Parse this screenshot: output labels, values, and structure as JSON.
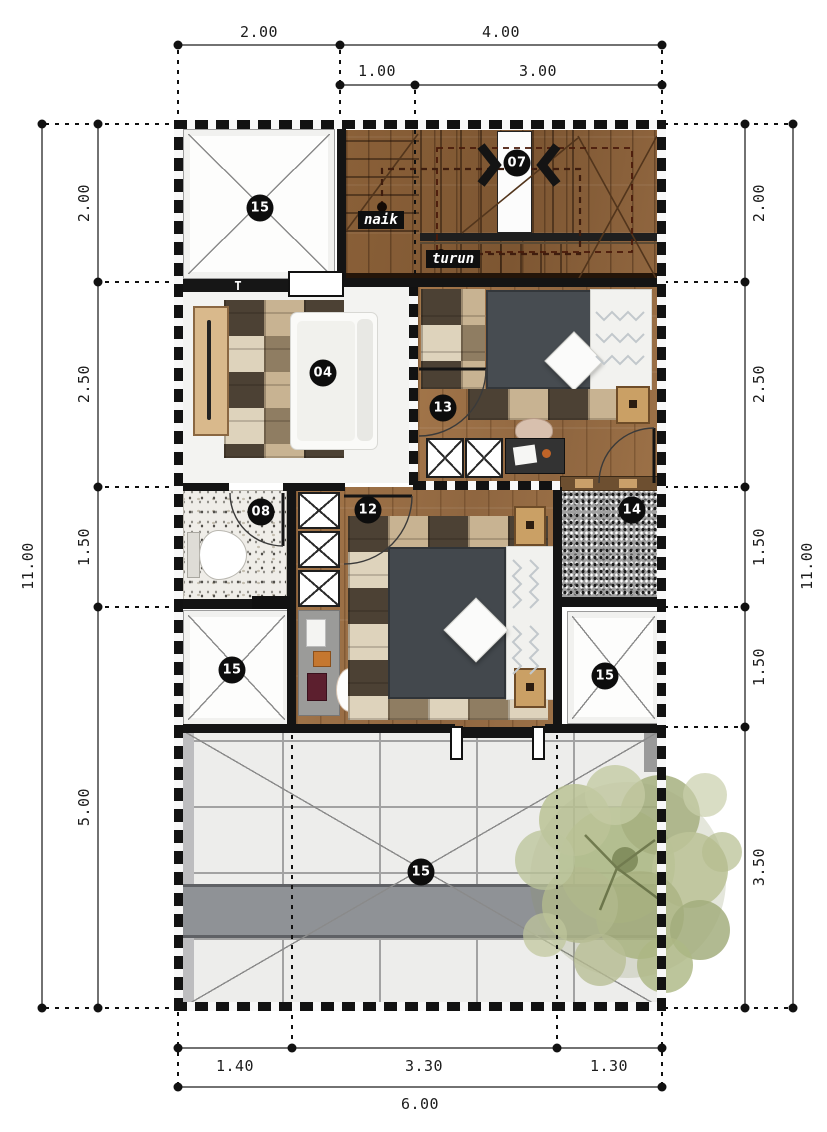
{
  "plan": {
    "markers": {
      "void_top": "15",
      "stairs": "07",
      "family_room": "04",
      "bedroom_front": "13",
      "bathroom": "08",
      "bedroom_master": "12",
      "gravel_court": "14",
      "void_left": "15",
      "void_right": "15",
      "roof_deck": "15"
    },
    "stair_up_label": "naik",
    "stair_down_label": "turun",
    "wall_symbol": "T"
  },
  "dimensions": {
    "top_row1": [
      "2.00",
      "4.00"
    ],
    "top_row2": [
      "1.00",
      "3.00"
    ],
    "left_total": "11.00",
    "left_segments": [
      "2.00",
      "2.50",
      "1.50",
      "5.00"
    ],
    "right_segments": [
      "2.00",
      "2.50",
      "1.50",
      "1.50",
      "3.50"
    ],
    "right_total": "11.00",
    "bottom_row1": [
      "1.40",
      "3.30",
      "1.30"
    ],
    "bottom_total": "6.00"
  },
  "colors": {
    "wall": "#141414",
    "wood_floor": "#9a7048",
    "marker_bg": "#0d0d0d",
    "glass_roof": "#ededeb",
    "tree_foliage": "#aeb886",
    "bed_duvet": "#474c51"
  }
}
